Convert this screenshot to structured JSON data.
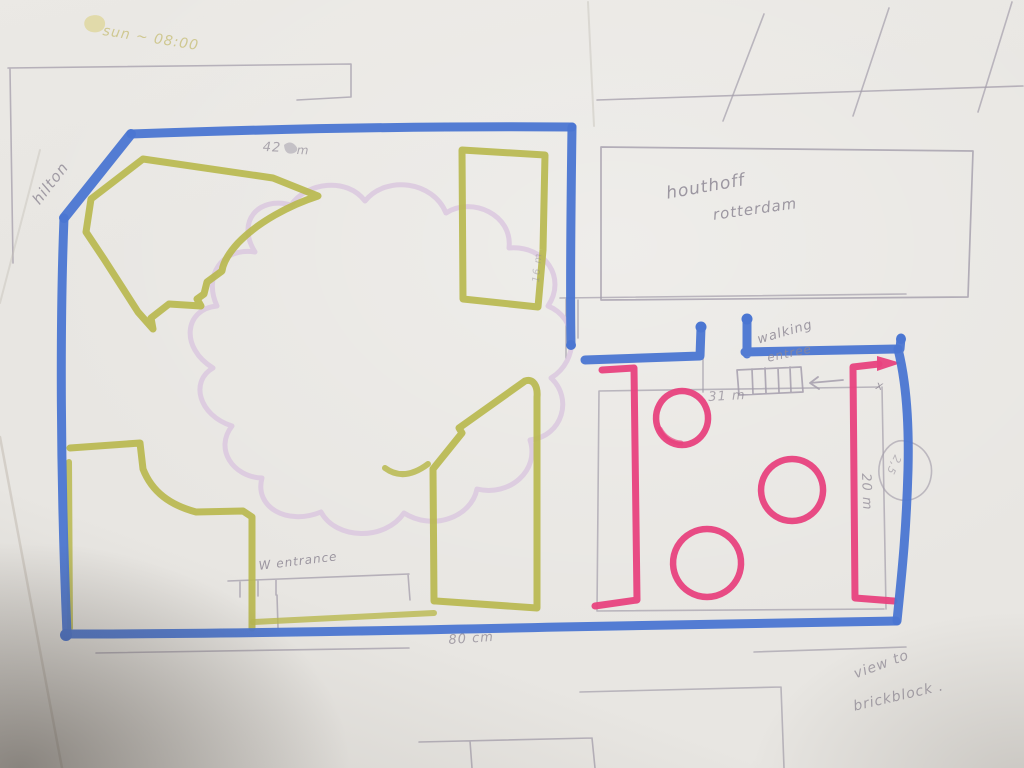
{
  "meta": {
    "scene": "photo of a hand-drawn garden floor plan sketch on paper"
  },
  "colors": {
    "paper": "#e8e6e2",
    "marker_blue": "#4b76d2",
    "marker_olive": "#b9b94f",
    "marker_pink": "#e8427e",
    "lavender": "#d9c5df",
    "pencil": "#8f8995",
    "pencil_light": "#a49eab",
    "highlighter": "#ded69b",
    "highlighter_text": "#cbc383",
    "crease": "#c6c0b8"
  },
  "annotations": [
    {
      "id": "sun-time",
      "text": "sun ~ 08:00",
      "x": 104,
      "y": 24,
      "rot": 9,
      "size": 14,
      "color": "highlighter_text",
      "op": 0.85
    },
    {
      "id": "hilton",
      "text": "hilton",
      "x": 30,
      "y": 198,
      "rot": -52,
      "size": 15,
      "color": "pencil",
      "op": 0.8
    },
    {
      "id": "dim-42",
      "text": "42",
      "x": 263,
      "y": 141,
      "rot": 2,
      "size": 13,
      "color": "pencil",
      "op": 0.7
    },
    {
      "id": "dim-42-unit",
      "text": "m",
      "x": 297,
      "y": 144,
      "rot": 2,
      "size": 12,
      "color": "pencil",
      "op": 0.7
    },
    {
      "id": "houthoff",
      "text": "houthoff",
      "x": 665,
      "y": 186,
      "rot": -10,
      "size": 17,
      "color": "pencil",
      "op": 0.85
    },
    {
      "id": "rotterdam",
      "text": "rotterdam",
      "x": 712,
      "y": 208,
      "rot": -8,
      "size": 15,
      "color": "pencil",
      "op": 0.85
    },
    {
      "id": "walking",
      "text": "walking",
      "x": 756,
      "y": 334,
      "rot": -16,
      "size": 13,
      "color": "pencil",
      "op": 0.85
    },
    {
      "id": "walking-2",
      "text": "entree",
      "x": 766,
      "y": 352,
      "rot": -12,
      "size": 12,
      "color": "pencil",
      "op": 0.8
    },
    {
      "id": "dim-31",
      "text": "31 m",
      "x": 708,
      "y": 391,
      "rot": -3,
      "size": 13,
      "color": "pencil",
      "op": 0.7
    },
    {
      "id": "x-mark",
      "text": "x",
      "x": 877,
      "y": 379,
      "rot": 10,
      "size": 12,
      "color": "pencil",
      "op": 0.8
    },
    {
      "id": "dim-20",
      "text": "20 m",
      "x": 872,
      "y": 473,
      "rot": 88,
      "size": 13,
      "color": "pencil",
      "op": 0.75
    },
    {
      "id": "dim-bubble",
      "text": "2,5",
      "x": 903,
      "y": 458,
      "rot": 115,
      "size": 11,
      "color": "pencil",
      "op": 0.55
    },
    {
      "id": "entrance",
      "text": "W entrance",
      "x": 258,
      "y": 560,
      "rot": -7,
      "size": 12,
      "color": "pencil",
      "op": 0.85
    },
    {
      "id": "dim-80",
      "text": "80 cm",
      "x": 448,
      "y": 634,
      "rot": -4,
      "size": 13,
      "color": "pencil",
      "op": 0.75
    },
    {
      "id": "view-to",
      "text": "view to",
      "x": 852,
      "y": 668,
      "rot": -20,
      "size": 14,
      "color": "pencil",
      "op": 0.75
    },
    {
      "id": "brickblock",
      "text": "brickblock .",
      "x": 852,
      "y": 700,
      "rot": -13,
      "size": 14,
      "color": "pencil",
      "op": 0.75
    },
    {
      "id": "dim-16",
      "text": "16 m",
      "x": 532,
      "y": 282,
      "rot": -85,
      "size": 10,
      "color": "pencil",
      "op": 0.45
    }
  ],
  "drawing": {
    "width": 1024,
    "height": 768,
    "paths": [
      {
        "n": "pencil-topleft-building",
        "d": "M 8,68 L 351,64 M 351,64 L 351,97 M 351,97 L 297,100 M 10,69 L 13,263",
        "c": "pencil_light",
        "w": 1.6,
        "o": 0.75
      },
      {
        "n": "pencil-topright-line",
        "d": "M 597,100 L 1023,86",
        "c": "pencil_light",
        "w": 1.6,
        "o": 0.75
      },
      {
        "n": "pencil-topright-diagonals",
        "d": "M 723,121 L 764,14 M 853,116 L 889,8 M 978,112 L 1012,2",
        "c": "pencil_light",
        "w": 1.6,
        "o": 0.7
      },
      {
        "n": "pencil-houthoff-building",
        "d": "M 601,147 L 973,151 L 968,297 L 601,300 Z",
        "c": "pencil_light",
        "w": 1.7,
        "o": 0.8
      },
      {
        "n": "pencil-wing-lines",
        "d": "M 560,298 L 906,294 M 566,299 L 566,358 M 578,300 L 578,338 M 703,358 L 703,392",
        "c": "pencil_light",
        "w": 1.6,
        "o": 0.7
      },
      {
        "n": "pencil-stairs",
        "d": "M 737,370 L 801,367 L 803,392 L 739,395 Z M 752,369 L 753,394 M 765,368 L 766,393 M 778,368 L 779,392 M 790,367 L 791,392",
        "c": "pencil_light",
        "w": 1.7,
        "o": 0.85
      },
      {
        "n": "pencil-stairs-arrow",
        "d": "M 843,380 L 810,383 M 818,377 L 810,383 L 819,389",
        "c": "pencil_light",
        "w": 1.8,
        "o": 0.85
      },
      {
        "n": "pencil-court-rect",
        "d": "M 599,391 L 879,387 M 882,387 L 886,609 M 599,391 L 597,611 M 597,611 L 884,609",
        "c": "pencil_light",
        "w": 1.6,
        "o": 0.7
      },
      {
        "n": "pencil-bottom-lines",
        "d": "M 96,653 L 409,648 M 228,581 L 409,574 M 240,582 L 240,597 M 258,581 L 258,596 M 276,580 L 276,595 M 277,595 L 278,628 M 408,574 L 410,600",
        "c": "pencil_light",
        "w": 1.6,
        "o": 0.75
      },
      {
        "n": "pencil-bottom-rect",
        "d": "M 419,742 L 592,738 M 592,738 L 595,768 M 470,741 L 472,768",
        "c": "pencil_light",
        "w": 1.6,
        "o": 0.75
      },
      {
        "n": "pencil-bottomright-lines",
        "d": "M 580,692 L 781,687 M 781,687 L 784,768 M 754,652 L 906,647",
        "c": "pencil_light",
        "w": 1.6,
        "o": 0.7
      },
      {
        "n": "pencil-dim-bubble-circle",
        "d": "M 905,441 C 924,444 934,460 931,477 C 928,495 911,504 897,499 C 883,494 876,478 880,462 C 884,448 894,439 905,441 Z",
        "c": "pencil_light",
        "w": 1.6,
        "o": 0.65
      },
      {
        "n": "paper-crease",
        "d": "M 0,303 L 40,150 M 588,2 L 594,126",
        "c": "crease",
        "w": 2,
        "o": 0.45
      },
      {
        "n": "paper-edge",
        "d": "M 0,437 L 62,768",
        "c": "crease",
        "w": 2.5,
        "o": 0.6
      },
      {
        "n": "pond-cloud",
        "d": "M 255,252 C 236,222 258,196 291,205 C 307,182 347,177 365,201 C 386,175 433,181 446,213 C 472,196 513,215 509,248 C 545,245 567,278 548,306 C 578,318 580,360 551,378 C 573,398 563,436 530,440 C 540,470 510,497 477,489 C 471,518 432,531 404,513 C 385,541 336,540 321,512 C 287,526 254,507 262,478 C 233,477 214,449 232,426 C 198,415 190,381 213,368 C 180,348 184,309 217,306 C 203,276 222,247 255,252 Z",
        "c": "lavender",
        "w": 5,
        "o": 0.8
      },
      {
        "n": "hedge-chevron",
        "d": "M 143,159 L 273,178 L 318,196 C 290,205 258,222 238,243 C 228,254 223,263 222,271 L 207,282 L 204,294 L 197,299 L 201,306 L 169,304 L 151,318 L 153,329 L 138,312 L 104,259 L 86,232 L 91,199 Z",
        "c": "marker_olive",
        "w": 7,
        "o": 0.92
      },
      {
        "n": "hedge-rect",
        "d": "M 462,150 L 545,155 L 543,250 L 538,307 L 463,299 Z",
        "c": "marker_olive",
        "w": 7,
        "o": 0.92
      },
      {
        "n": "hedge-steps",
        "d": "M 70,448 L 140,443 L 143,469 C 152,492 170,505 196,512 L 243,511 L 252,517 L 252,628",
        "c": "marker_olive",
        "w": 7,
        "o": 0.92
      },
      {
        "n": "hedge-left-edge",
        "d": "M 69,462 L 70,628",
        "c": "marker_olive",
        "w": 6,
        "o": 0.85
      },
      {
        "n": "hedge-block",
        "d": "M 434,601 L 433,469 L 462,433 L 459,428 L 525,381 C 533,378 538,386 537,397 L 537,608 L 436,601 Z",
        "c": "marker_olive",
        "w": 7,
        "o": 0.92
      },
      {
        "n": "hedge-dash",
        "d": "M 385,468 Q 404,482 428,464",
        "c": "marker_olive",
        "w": 6,
        "o": 0.85
      },
      {
        "n": "hedge-bottom-line",
        "d": "M 253,622 L 434,613",
        "c": "marker_olive",
        "w": 6,
        "o": 0.8
      },
      {
        "n": "pink-bracket-left",
        "d": "M 602,370 L 634,368 L 637,600 L 595,606",
        "c": "marker_pink",
        "w": 7,
        "o": 0.95
      },
      {
        "n": "pink-bracket-right",
        "d": "M 879,364 L 853,367 L 855,598 L 894,601",
        "c": "marker_pink",
        "w": 7,
        "o": 0.95
      },
      {
        "n": "pink-arrowhead",
        "d": "M 877,356 L 901,363 L 877,371 Z",
        "f": "marker_pink",
        "o": 0.95
      },
      {
        "n": "pink-circle-1",
        "d": "M 682,391 a 26,27 0 1 0 0.1,0 Z",
        "c": "marker_pink",
        "w": 6.5,
        "o": 0.95
      },
      {
        "n": "pink-circle-1-overlap",
        "d": "M 660,429 a 26,26 0 0 0 21,14",
        "c": "marker_pink",
        "w": 5,
        "o": 0.7
      },
      {
        "n": "pink-circle-2",
        "d": "M 792,459 a 31,31 0 1 0 0.1,0 Z",
        "c": "marker_pink",
        "w": 6.5,
        "o": 0.95
      },
      {
        "n": "pink-circle-3",
        "d": "M 707,529 a 34,34 0 1 0 0.1,0 Z",
        "c": "marker_pink",
        "w": 6.5,
        "o": 0.95
      },
      {
        "n": "blue-outline-top",
        "d": "M 131,134 C 270,129 430,126 572,127",
        "c": "marker_blue",
        "w": 9,
        "o": 0.95
      },
      {
        "n": "blue-inner-right",
        "d": "M 572,127 C 571,200 570,290 571,343",
        "c": "marker_blue",
        "w": 9,
        "o": 0.95
      },
      {
        "n": "blue-diagonal",
        "d": "M 131,134 L 64,218",
        "c": "marker_blue",
        "w": 10,
        "o": 0.95
      },
      {
        "n": "blue-left-edge",
        "d": "M 64,218 C 60,320 60,470 67,634",
        "c": "marker_blue",
        "w": 9,
        "o": 0.95
      },
      {
        "n": "blue-bottom-edge",
        "d": "M 67,634 C 230,634 420,630 560,627 C 690,624 800,623 896,621",
        "c": "marker_blue",
        "w": 9,
        "o": 0.95
      },
      {
        "n": "blue-wing-left",
        "d": "M 585,360 L 700,356 M 700,356 L 701,328",
        "c": "marker_blue",
        "w": 9,
        "o": 0.95
      },
      {
        "n": "blue-wing-right",
        "d": "M 747,320 L 747,354 M 745,352 L 898,349",
        "c": "marker_blue",
        "w": 9,
        "o": 0.95
      },
      {
        "n": "blue-right-edge",
        "d": "M 898,349 C 907,385 909,430 908,470 C 906,540 901,580 897,621 M 900,349 L 901,338",
        "c": "marker_blue",
        "w": 9,
        "o": 0.95
      },
      {
        "n": "sun-highlight-blob",
        "d": "M 90,16 C 99,13 106,18 105,25 C 104,32 95,34 89,31 C 83,28 82,19 90,16 Z",
        "f": "highlighter",
        "o": 0.8
      },
      {
        "n": "pencil-scribble-blob",
        "d": "M 284,145 q 6,-5 11,0 q 5,5 -1,8 q -9,3 -10,-8 Z",
        "f": "pencil_light",
        "o": 0.55
      }
    ],
    "dots": [
      {
        "n": "blue-blob-1",
        "x": 571,
        "y": 345,
        "r": 5,
        "c": "marker_blue"
      },
      {
        "n": "blue-blob-2",
        "x": 701,
        "y": 327,
        "r": 5.5,
        "c": "marker_blue"
      },
      {
        "n": "blue-blob-3",
        "x": 747,
        "y": 319,
        "r": 5.5,
        "c": "marker_blue"
      },
      {
        "n": "blue-blob-4",
        "x": 901,
        "y": 339,
        "r": 5,
        "c": "marker_blue"
      },
      {
        "n": "blue-blob-5",
        "x": 66,
        "y": 635,
        "r": 6,
        "c": "marker_blue"
      }
    ]
  }
}
